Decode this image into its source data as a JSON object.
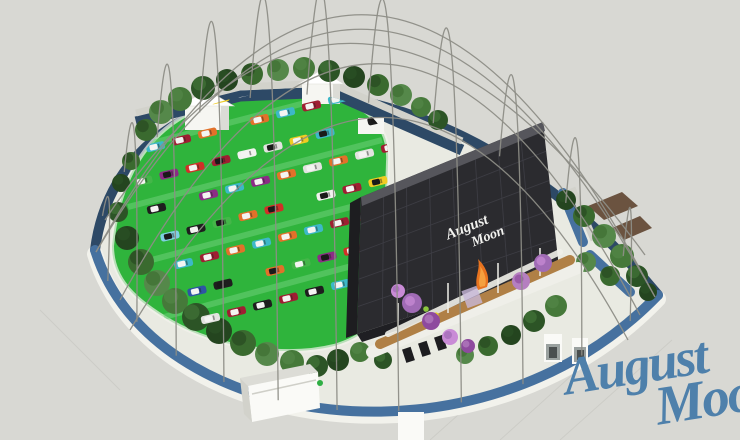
{
  "scene_description": "Aerial rendering of August Moon drive-in theater under wireframe dome",
  "logo": {
    "line1": "August",
    "line2": "Moon",
    "color": "#4e80ab"
  },
  "screen": {
    "line1": "August",
    "line2": "Moon",
    "text_color": "#f2f2ef"
  },
  "palette": {
    "background": "#d8d8d3",
    "apron": "#e9eae2",
    "rim": "#f2f2ec",
    "walkway": "#d2d2cb",
    "wall_front": "#46719f",
    "wall_back": "#2d4966",
    "lawn": "#2fb43c",
    "lane": "#6ecf79",
    "screen_face": "#2b2b2f",
    "screen_side": "#1d1d20",
    "screen_top": "#56565c",
    "screen_line": "#3f3f46",
    "screen_base": "#1f1f23",
    "screen_text": "#f2f2ef",
    "boardwalk": "#b08046",
    "planter": "#efefe9",
    "building": "#f6f6f2",
    "building_shade": "#dcdcd6",
    "roof_white": "#ffffff",
    "booth": "#fafaf7",
    "kiosk_front": "#9aa19f",
    "canopy": "#6b5340",
    "sculpture": "#e8731f",
    "sculpture_glow": "#f4a03f",
    "dome": "#8d8d86",
    "seam": "#c8c8c2",
    "logo": "#4e80ab"
  },
  "cars": {
    "rows": 8,
    "cols": 10,
    "body_colors": [
      "#d03028",
      "#3db8c8",
      "#f2f2ef",
      "#1e1e1e",
      "#f0cc22",
      "#e2712a",
      "#2e55a4",
      "#8c2c86",
      "#7fcfe2",
      "#9f1f32",
      "#44b649",
      "#e3e3e0"
    ],
    "roof_light": "#f4f4f2",
    "roof_dark": "#1a1a1a"
  },
  "trees": {
    "greens": [
      "#2c5426",
      "#3a6a2f",
      "#46793a",
      "#24451f",
      "#55884a"
    ],
    "purples": [
      "#a06bb5",
      "#8e4a9e",
      "#c98bd6",
      "#b57fc0"
    ]
  },
  "dome": {
    "hoop_count": 11,
    "color": "#8d8d86"
  }
}
